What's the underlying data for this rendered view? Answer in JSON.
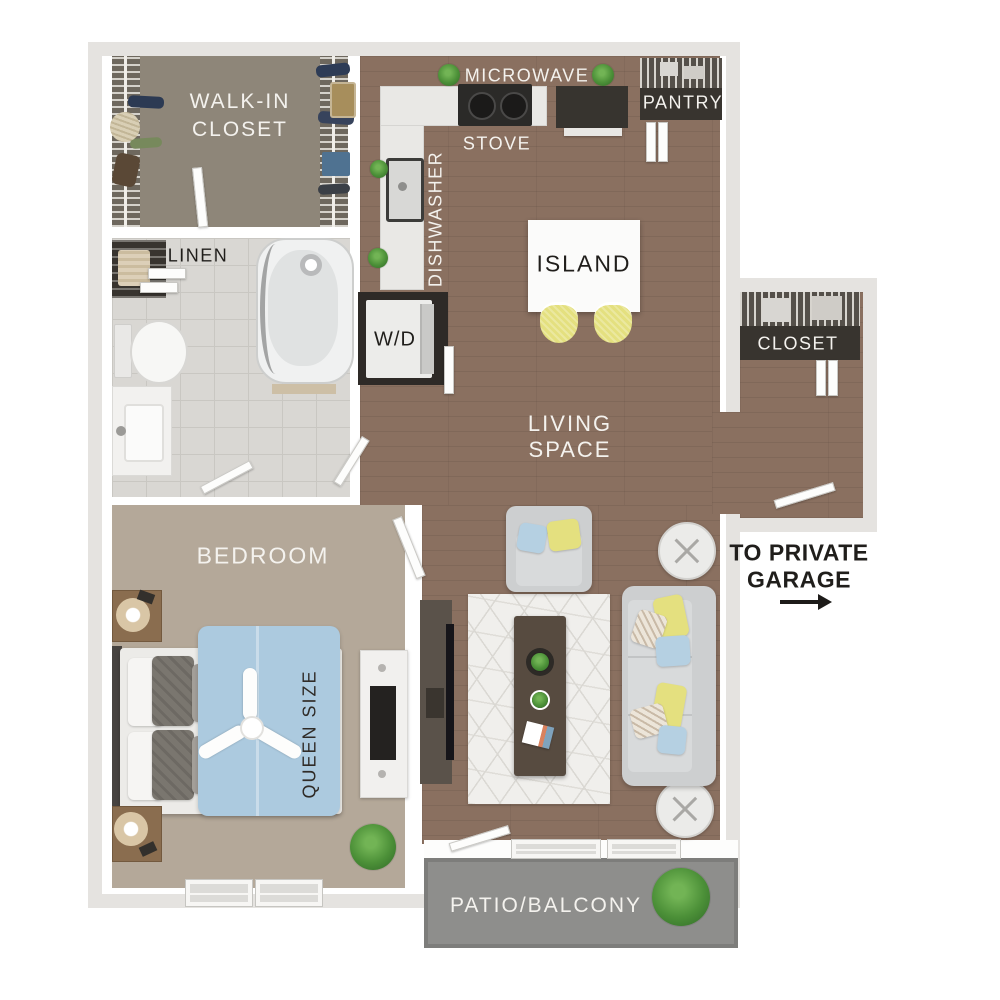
{
  "plan_title": "One bedroom apartment floor plan",
  "labels": {
    "walk_in_closet": {
      "line1": "WALK-IN",
      "line2": "CLOSET"
    },
    "linen": "LINEN",
    "microwave": "MICROWAVE",
    "stove": "STOVE",
    "dishwasher": "DISHWASHER",
    "pantry": "PANTRY",
    "island": "ISLAND",
    "washer_dryer": "W/D",
    "entry_closet": "CLOSET",
    "living_space": {
      "line1": "LIVING",
      "line2": "SPACE"
    },
    "bedroom": "BEDROOM",
    "bed_size": "QUEEN SIZE",
    "garage": {
      "line1": "TO PRIVATE",
      "line2": "GARAGE"
    },
    "patio": "PATIO/BALCONY"
  },
  "colors": {
    "wall_outer": "#e5e3e0",
    "wood": "#8a7060",
    "carpet": "#b4a899",
    "closet_floor": "#8e8679",
    "tile": "#d9d7d3",
    "tile_line": "#c9c7c2",
    "patio": "#8e8e8c",
    "dark_closet": "#38342f",
    "counter": "#e9e8e5",
    "accent_yellow": "#e4e07f",
    "accent_blue": "#b5d0e2",
    "sofa_gray": "#cdcfd0",
    "rug": "#f0efec",
    "duvet_blue": "#accadf",
    "label_light": "#f4f2ee",
    "label_dark": "#201e1b"
  }
}
